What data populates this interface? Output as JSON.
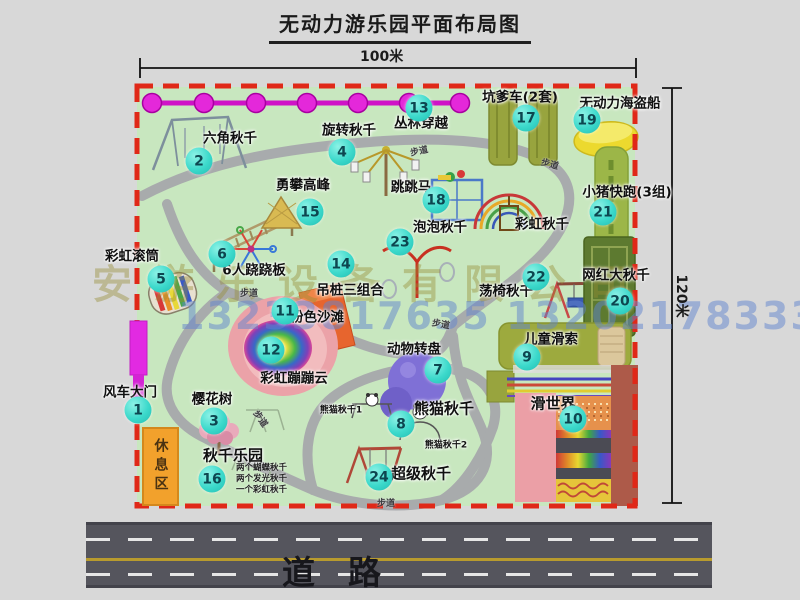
{
  "title": "无动力游乐园平面布局图",
  "dimensions": {
    "width": "100米",
    "height": "120米"
  },
  "road_label": "道　路",
  "walkway_label": "步道",
  "rest_area_label": "休息区",
  "watermarks": {
    "company": "安游乐设备有限公司",
    "phone": "13233817635 13202178333"
  },
  "attractions": [
    {
      "num": "1",
      "label": "风车大门"
    },
    {
      "num": "2",
      "label": "六角秋千"
    },
    {
      "num": "3",
      "label": "樱花树"
    },
    {
      "num": "4",
      "label": "旋转秋千"
    },
    {
      "num": "5",
      "label": "彩虹滚筒"
    },
    {
      "num": "6",
      "label": "6人跷跷板"
    },
    {
      "num": "7",
      "label": "动物转盘"
    },
    {
      "num": "8",
      "label": "熊猫秋千"
    },
    {
      "num": "9",
      "label": "儿童滑索"
    },
    {
      "num": "10",
      "label": "滑世界"
    },
    {
      "num": "11",
      "label": "粉色沙滩"
    },
    {
      "num": "12",
      "label": "彩虹蹦蹦云"
    },
    {
      "num": "13",
      "label": "丛林穿越"
    },
    {
      "num": "14",
      "label": "吊桩三组合"
    },
    {
      "num": "15",
      "label": "勇攀高峰"
    },
    {
      "num": "16",
      "label": "秋千乐园"
    },
    {
      "num": "17",
      "label": "坑爹车(2套)"
    },
    {
      "num": "18",
      "label": "跳跳马"
    },
    {
      "num": "19",
      "label": "无动力海盗船"
    },
    {
      "num": "20",
      "label": "网红大秋千"
    },
    {
      "num": "21",
      "label": "小猪快跑(3组)"
    },
    {
      "num": "22",
      "label": "荡椅秋千"
    },
    {
      "num": "23",
      "label": "泡泡秋千"
    },
    {
      "num": "24",
      "label": "超级秋千"
    }
  ],
  "extras": {
    "rainbow_swing": "彩虹秋千",
    "panda_swing_1": "熊猫秋千1",
    "panda_swing_2": "熊猫秋千2",
    "notes": [
      "两个蝴蝶秋千",
      "两个发光秋千",
      "一个彩虹秋千"
    ]
  }
}
